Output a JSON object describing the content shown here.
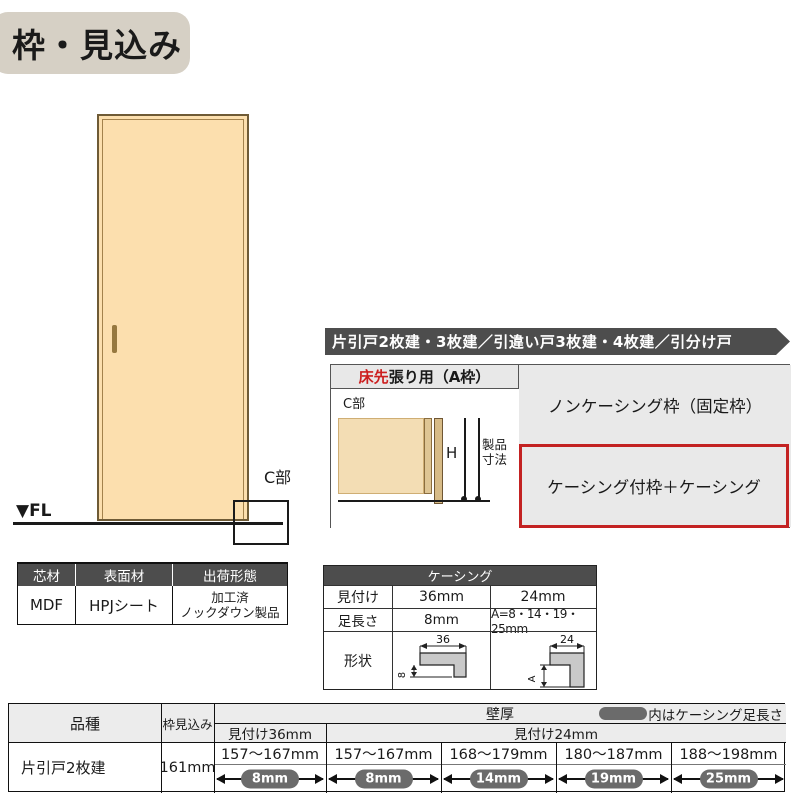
{
  "page": {
    "title": "枠・見込み"
  },
  "door_figure": {
    "fl_label": "▼FL",
    "c_section_label": "C部"
  },
  "banner": {
    "text": "片引戸2枚建・3枚建／引違い戸3枚建・4枚建／引分け戸"
  },
  "frame_table": {
    "header_red": "床先",
    "header_rest": "張り用（A枠）",
    "diagram": {
      "c_label": "C部",
      "h_label": "H",
      "product_dim_line1": "製品",
      "product_dim_line2": "寸法"
    },
    "row_noncasing": "ノンケーシング枠（固定枠）",
    "row_casing": "ケーシング付枠＋ケーシング"
  },
  "materials_table": {
    "headers": [
      "芯材",
      "表面材",
      "出荷形態"
    ],
    "core": "MDF",
    "surface": "HPJシート",
    "shipping_line1": "加工済",
    "shipping_line2": "ノックダウン製品"
  },
  "casing_table": {
    "title": "ケーシング",
    "row_face": {
      "label": "見付け",
      "v36": "36mm",
      "v24": "24mm"
    },
    "row_leg": {
      "label": "足長さ",
      "v36": "8mm",
      "v24": "A=8・14・19・25mm"
    },
    "row_shape_label": "形状",
    "shape36": {
      "width_dim": "36",
      "leg_dim": "8"
    },
    "shape24": {
      "width_dim": "24",
      "leg_dim": "A"
    }
  },
  "spec_table": {
    "col_product": "品種",
    "col_frame_depth": "枠見込み",
    "wall_header": "壁厚",
    "legend_text": "内はケーシング足長さ",
    "sub36": "見付け36mm",
    "sub24": "見付け24mm",
    "product": "片引戸2枚建",
    "frame_depth": "161mm",
    "columns": [
      {
        "range": "157～167mm",
        "leg": "8mm"
      },
      {
        "range": "157～167mm",
        "leg": "8mm"
      },
      {
        "range": "168～179mm",
        "leg": "14mm"
      },
      {
        "range": "180～187mm",
        "leg": "19mm"
      },
      {
        "range": "188～198mm",
        "leg": "25mm"
      }
    ]
  },
  "colors": {
    "accent_red": "#c32222",
    "text_red": "#cc1f1f",
    "dark_header": "#4d4d4d",
    "pill_gray": "#6b6b6b",
    "door_fill": "#fcdfae",
    "title_bg": "#d6d0c5",
    "cell_gray": "#e9e9e9",
    "header_gray": "#ececec"
  }
}
